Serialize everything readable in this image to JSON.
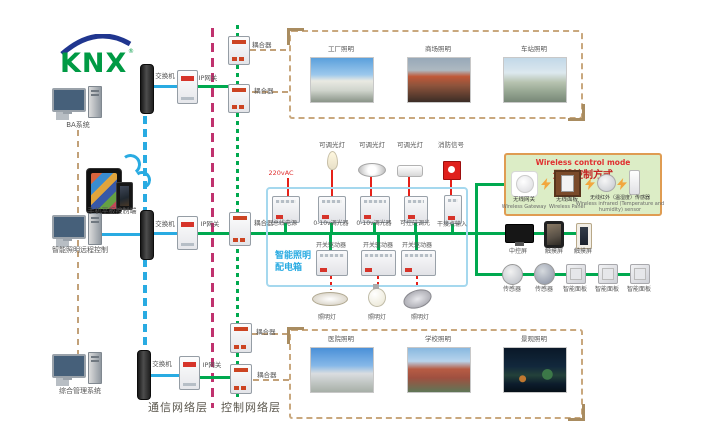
{
  "logo": {
    "text": "KNX"
  },
  "layers": {
    "comm": "通信网络层",
    "ctrl": "控制网络层"
  },
  "labels": {
    "switch": "交换机",
    "gateway": "IP网关",
    "coupler": "耦合器",
    "power": "220vAC"
  },
  "left": {
    "ba": "BA系统",
    "mobile": "手机平板控制端",
    "remote": "智能照明远程控制",
    "mgmt": "综合管理系统"
  },
  "cabinet": {
    "title1": "智能照明",
    "title2": "配电箱",
    "loads": [
      "可调光灯",
      "可调光灯",
      "可调光灯",
      "消防信号"
    ],
    "row1": [
      "总线电源",
      "0-10v调光器",
      "0-10v调光器",
      "可控硅调光",
      "干接点输入"
    ],
    "row2": [
      "开关驱动器",
      "开关驱动器",
      "开关驱动器"
    ],
    "lamps": [
      "照明灯",
      "照明灯",
      "照明灯"
    ]
  },
  "wireless": {
    "title_en": "Wireless control mode",
    "title_zh": "无线控制方式",
    "items": [
      {
        "zh": "无线网关",
        "en": "Wireless Gateway"
      },
      {
        "zh": "无线面板",
        "en": "Wireless Panel"
      },
      {
        "zh": "无线红外（温湿度）传感器",
        "en1": "Wireless infrared (Temperature and",
        "en2": "humidity) sensor"
      }
    ]
  },
  "screens": [
    "中控屏",
    "触摸屏",
    "触摸屏"
  ],
  "sensors": [
    "传感器",
    "传感器",
    "智能面板",
    "智能面板",
    "智能面板"
  ],
  "photos": {
    "top": [
      "工厂照明",
      "商场照明",
      "车站照明"
    ],
    "bottom": [
      "医院照明",
      "学校照明",
      "景观照明"
    ]
  },
  "colors": {
    "knx_green": "#00a94f",
    "ethernet_blue": "#29abe2",
    "layer_divider_magenta": "#c0326e",
    "management_tan": "#c2a179",
    "power_red": "#e62119"
  }
}
